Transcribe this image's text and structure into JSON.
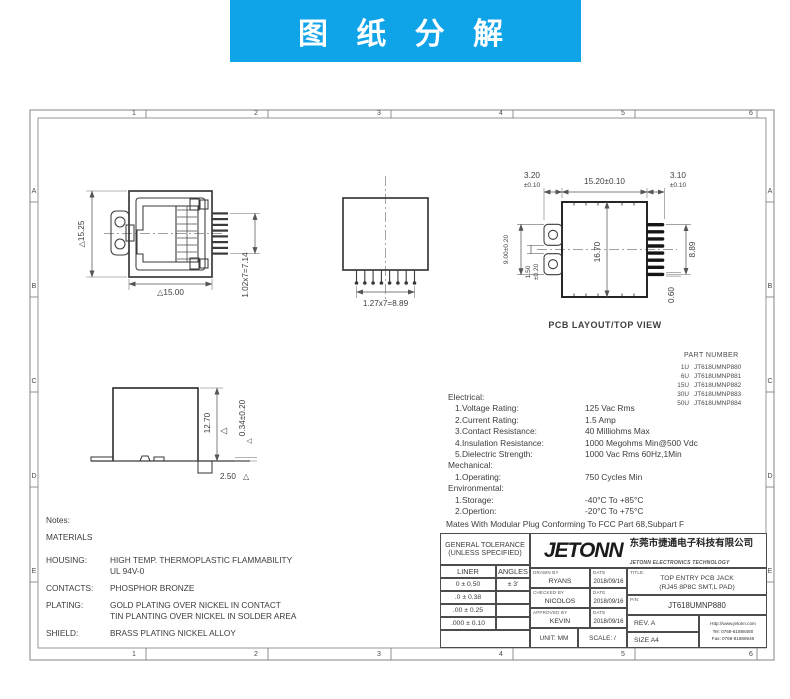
{
  "banner": {
    "title": "图 纸 分 解"
  },
  "colors": {
    "accent": "#0fa3e8",
    "line": "#3f3f3f"
  },
  "icons": {
    "triangle": "△"
  },
  "frame": {
    "top": [
      "1",
      "2",
      "3",
      "4",
      "5",
      "6"
    ],
    "bottom": [
      "1",
      "2",
      "3",
      "4",
      "5",
      "6"
    ],
    "left": [
      "A",
      "B",
      "C",
      "D",
      "E"
    ],
    "right": [
      "A",
      "B",
      "C",
      "D",
      "E"
    ]
  },
  "front_view": {
    "height": "△15.25",
    "width": "△15.00",
    "pins": "1.02x7=7.14"
  },
  "bottom_view": {
    "pitch": "1.27x7=8.89"
  },
  "pcb_view": {
    "label": "PCB LAYOUT/TOP VIEW",
    "left_off": "3.20",
    "left_tol": "±0.10",
    "width": "15.20±0.10",
    "right_off": "3.10",
    "right_tol": "±0.10",
    "tab_span": "9.00±0.20",
    "slot": "1.50",
    "slot_tol": "±0.20",
    "height": "16.70",
    "pad_span": "8.89",
    "pad_h": "0.60"
  },
  "side_view": {
    "height": "12.70",
    "pad": "0.34±0.20",
    "foot": "2.50"
  },
  "part_numbers": {
    "title": "PART NUMBER",
    "rows": [
      {
        "code": "1U",
        "pn": "JT618UMNP880"
      },
      {
        "code": "6U",
        "pn": "JT618UMNP881"
      },
      {
        "code": "15U",
        "pn": "JT618UMNP882"
      },
      {
        "code": "30U",
        "pn": "JT618UMNP883"
      },
      {
        "code": "50U",
        "pn": "JT618UMNP884"
      }
    ]
  },
  "specs": {
    "rows": [
      {
        "label": "Electrical:",
        "value": ""
      },
      {
        "label": "1.Voltage Rating:",
        "value": "125 Vac Rms"
      },
      {
        "label": "2.Current Rating:",
        "value": "1.5 Amp"
      },
      {
        "label": "3.Contact Resistance:",
        "value": "40 Milliohms Max"
      },
      {
        "label": "4.Insulation Resistance:",
        "value": "1000 Megohms Min@500 Vdc"
      },
      {
        "label": "5.Dielectric Strength:",
        "value": "1000 Vac Rms 60Hz,1Min"
      },
      {
        "label": "Mechanical:",
        "value": ""
      },
      {
        "label": "1.Operating:",
        "value": "750 Cycles Min"
      },
      {
        "label": "Environmental:",
        "value": ""
      },
      {
        "label": "1.Storage:",
        "value": "-40°C To +85°C"
      },
      {
        "label": "2.Opertion:",
        "value": "-20°C To +75°C"
      }
    ],
    "footer": "Mates With Modular Plug Conforming To FCC Part 68,Subpart F"
  },
  "notes": {
    "title": "Notes:",
    "subtitle": "MATERIALS",
    "rows": [
      {
        "label": "HOUSING:",
        "line1": "HIGH TEMP. THERMOPLASTIC FLAMMABILITY",
        "line2": "UL 94V-0"
      },
      {
        "label": "CONTACTS:",
        "line1": "PHOSPHOR BRONZE",
        "line2": ""
      },
      {
        "label": "PLATING:",
        "line1": "GOLD PLATING OVER NICKEL IN CONTACT",
        "line2": "TIN PLANTING OVER NICKEL IN SOLDER AREA"
      },
      {
        "label": "SHIELD:",
        "line1": "BRASS PLATING NICKEL ALLOY",
        "line2": ""
      }
    ]
  },
  "title_block": {
    "tolerance": {
      "title1": "GENERAL TOLERANCE",
      "title2": "(UNLESS SPECIFIED)",
      "col1": "LINER",
      "col2": "ANGLES",
      "rows": [
        [
          "0 ± 0.50",
          "± 3'"
        ],
        [
          ".0 ± 0.38",
          ""
        ],
        [
          ".00 ± 0.25",
          ""
        ],
        [
          ".000 ± 0.10",
          ""
        ]
      ]
    },
    "company": {
      "logo": "JETONN",
      "name_cn": "东莞市捷通电子科技有限公司",
      "name_en": "JETONN ELECTRONICS TECHNOLOGY"
    },
    "sign": {
      "drawn_label": "DRAWN BY",
      "drawn": "RYANS",
      "checked_label": "CHECKED BY",
      "checked": "NICOLOS",
      "approved_label": "APPROVED BY",
      "approved": "KEVIN",
      "date_label": "DATE",
      "date": "2018/09/16"
    },
    "unit": "UNIT:  MM",
    "scale": "SCALE:  /",
    "title_label": "TITLE:",
    "title1": "TOP ENTRY PCB JACK",
    "title2": "(RJ45 8P8C SMT,L PAD)",
    "pn_label": "P/N:",
    "pn": "JT618UMNP880",
    "rev": "REV.  A",
    "size": "SIZE  A4",
    "web": "Http://www.jetonn.com",
    "tel": "Tel:  0769-81888480",
    "fax": "Fax:  0769-81888946"
  }
}
